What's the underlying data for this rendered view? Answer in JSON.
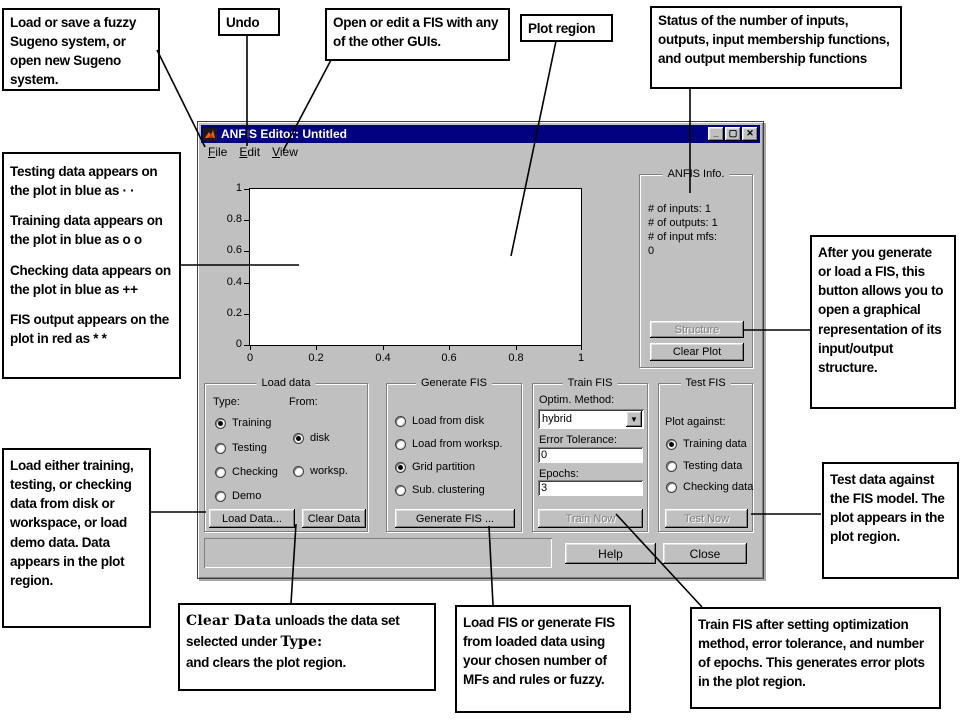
{
  "window": {
    "title": "ANFIS Editor: Untitled",
    "icon": "matlab-logo-icon",
    "controls": {
      "minimize": "_",
      "maximize": "▢",
      "close": "✕"
    },
    "menu": [
      "File",
      "Edit",
      "View"
    ]
  },
  "plot": {
    "y_ticks": [
      "1",
      "0.8",
      "0.6",
      "0.4",
      "0.2",
      "0"
    ],
    "x_ticks": [
      "0",
      "0.2",
      "0.4",
      "0.6",
      "0.8",
      "1"
    ]
  },
  "anfis_info": {
    "title": "ANFIS Info.",
    "info_lines": [
      "# of inputs: 1",
      "# of outputs: 1",
      "# of input mfs:",
      "0"
    ],
    "structure_button": "Structure",
    "clear_plot_button": "Clear Plot"
  },
  "load_data": {
    "title": "Load data",
    "type_label": "Type:",
    "from_label": "From:",
    "type_options": [
      {
        "label": "Training",
        "selected": true
      },
      {
        "label": "Testing",
        "selected": false
      },
      {
        "label": "Checking",
        "selected": false
      },
      {
        "label": "Demo",
        "selected": false
      }
    ],
    "from_options": [
      {
        "label": "disk",
        "selected": true
      },
      {
        "label": "worksp.",
        "selected": false
      }
    ],
    "load_button": "Load Data...",
    "clear_button": "Clear Data"
  },
  "generate_fis": {
    "title": "Generate FIS",
    "options": [
      {
        "label": "Load from disk",
        "selected": false
      },
      {
        "label": "Load from worksp.",
        "selected": false
      },
      {
        "label": "Grid partition",
        "selected": true
      },
      {
        "label": "Sub. clustering",
        "selected": false
      }
    ],
    "button": "Generate FIS ..."
  },
  "train_fis": {
    "title": "Train FIS",
    "optim_label": "Optim. Method:",
    "optim_value": "hybrid",
    "error_label": "Error Tolerance:",
    "error_value": "0",
    "epochs_label": "Epochs:",
    "epochs_value": "3",
    "button": "Train Now",
    "button_enabled": false
  },
  "test_fis": {
    "title": "Test FIS",
    "plot_against_label": "Plot against:",
    "options": [
      {
        "label": "Training data",
        "selected": true
      },
      {
        "label": "Testing data",
        "selected": false
      },
      {
        "label": "Checking data",
        "selected": false
      }
    ],
    "button": "Test Now",
    "button_enabled": false
  },
  "footer": {
    "help_button": "Help",
    "close_button": "Close"
  },
  "callouts": {
    "load_save": "Load or save a fuzzy Sugeno system, or open new Sugeno system.",
    "undo": "Undo",
    "open_edit": "Open or edit a FIS with any of the other GUIs.",
    "plot_region": "Plot region",
    "status": "Status of the number of inputs, outputs, input membership functions, and output membership functions",
    "markers": {
      "lines": [
        "Testing data appears on the plot in blue as  · ·",
        "Training data appears on the plot in blue as o  o",
        "Checking data appears on the plot in blue as ++",
        "FIS output appears on the plot in red as * *"
      ]
    },
    "load_either": "Load either training, testing, or checking data from disk or workspace, or load demo data. Data appears in the plot region.",
    "structure": "After you generate or load a FIS, this button allows you to open a graphical representation of its input/output structure.",
    "test_data": "Test data against the FIS model. The plot appears in the plot region.",
    "clear_data": {
      "bold1": "Clear Data",
      "part1": " unloads the data set selected under ",
      "bold2": "Type:",
      "part2": "and clears the plot region."
    },
    "load_fis": "Load FIS or generate FIS from loaded data using your chosen number of MFs and rules or fuzzy.",
    "train_fis": "Train FIS after setting optimization method, error tolerance, and number of epochs. This generates error plots in the plot region."
  },
  "colors": {
    "titlebar": "#000080",
    "chrome": "#c0c0c0",
    "disabled_text": "#808080"
  }
}
